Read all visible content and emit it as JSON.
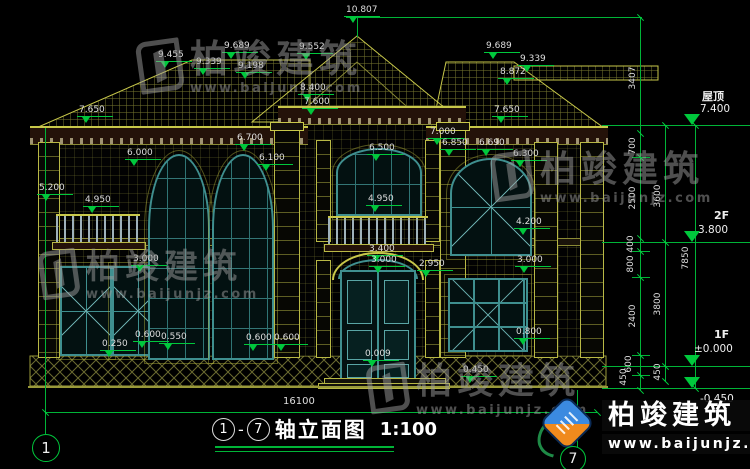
{
  "title": {
    "axis_from": "1",
    "dash": "-",
    "axis_to": "7",
    "name": "轴立面图",
    "scale": "1:100"
  },
  "bottom_dim": "16100",
  "axis_bubbles": {
    "left": "1",
    "right": "7"
  },
  "colors": {
    "dim_green": "#00c83c",
    "line_olive": "#b8b845",
    "window_teal": "#3f8f8f",
    "cornice_maroon": "#241209",
    "logo_blue": "#3b8ae0",
    "logo_orange": "#f08a1d"
  },
  "watermark": {
    "brand": "柏竣建筑",
    "url": "www.baijunjz.com",
    "instances": [
      {
        "x": 138,
        "y": 40,
        "cs": 38,
        "us": 13,
        "lw": 44,
        "lh": 52,
        "colored": false
      },
      {
        "x": 40,
        "y": 250,
        "cs": 34,
        "us": 13,
        "lw": 38,
        "lh": 48,
        "colored": false
      },
      {
        "x": 492,
        "y": 152,
        "cs": 36,
        "us": 13,
        "lw": 40,
        "lh": 48,
        "colored": false
      },
      {
        "x": 368,
        "y": 364,
        "cs": 36,
        "us": 13,
        "lw": 40,
        "lh": 48,
        "colored": false
      },
      {
        "x": 540,
        "y": 400,
        "cs": 27,
        "us": 14,
        "lw": 54,
        "lh": 56,
        "colored": true
      }
    ]
  },
  "elevation_markers": [
    {
      "v": "10.807",
      "x": 346,
      "y": 6
    },
    {
      "v": "9.552",
      "x": 299,
      "y": 43
    },
    {
      "v": "9.455",
      "x": 158,
      "y": 51
    },
    {
      "v": "9.339",
      "x": 196,
      "y": 58
    },
    {
      "v": "9.689",
      "x": 224,
      "y": 42
    },
    {
      "v": "9.198",
      "x": 238,
      "y": 62
    },
    {
      "v": "9.689",
      "x": 486,
      "y": 42
    },
    {
      "v": "9.339",
      "x": 520,
      "y": 55
    },
    {
      "v": "8.872",
      "x": 500,
      "y": 68
    },
    {
      "v": "8.400",
      "x": 300,
      "y": 84
    },
    {
      "v": "7.600",
      "x": 304,
      "y": 98
    },
    {
      "v": "7.650",
      "x": 79,
      "y": 106
    },
    {
      "v": "7.650",
      "x": 494,
      "y": 106
    },
    {
      "v": "7.000",
      "x": 430,
      "y": 128
    },
    {
      "v": "6.850",
      "x": 442,
      "y": 139
    },
    {
      "v": "6.690",
      "x": 479,
      "y": 139
    },
    {
      "v": "6.300",
      "x": 513,
      "y": 150
    },
    {
      "v": "6.700",
      "x": 237,
      "y": 134
    },
    {
      "v": "6.100",
      "x": 259,
      "y": 154
    },
    {
      "v": "6.000",
      "x": 127,
      "y": 149
    },
    {
      "v": "6.500",
      "x": 369,
      "y": 144
    },
    {
      "v": "5.200",
      "x": 39,
      "y": 184
    },
    {
      "v": "4.950",
      "x": 85,
      "y": 196
    },
    {
      "v": "4.950",
      "x": 368,
      "y": 195
    },
    {
      "v": "4.200",
      "x": 516,
      "y": 218
    },
    {
      "v": "3.400",
      "x": 369,
      "y": 245
    },
    {
      "v": "3.000",
      "x": 371,
      "y": 256
    },
    {
      "v": "2.950",
      "x": 419,
      "y": 260
    },
    {
      "v": "3.000",
      "x": 133,
      "y": 255
    },
    {
      "v": "3.000",
      "x": 517,
      "y": 256
    },
    {
      "v": "0.250",
      "x": 102,
      "y": 340
    },
    {
      "v": "0.600",
      "x": 135,
      "y": 331
    },
    {
      "v": "0.550",
      "x": 161,
      "y": 333
    },
    {
      "v": "0.600",
      "x": 246,
      "y": 334
    },
    {
      "v": "0.600",
      "x": 274,
      "y": 334
    },
    {
      "v": "0.800",
      "x": 516,
      "y": 328
    },
    {
      "v": "0.450",
      "x": 463,
      "y": 366
    },
    {
      "v": "0.009",
      "x": 365,
      "y": 350
    }
  ],
  "vertical_dims": [
    {
      "v": "3407",
      "x": 633,
      "y": 78
    },
    {
      "v": "700",
      "x": 633,
      "y": 146
    },
    {
      "v": "2500",
      "x": 633,
      "y": 198
    },
    {
      "v": "400",
      "x": 631,
      "y": 244
    },
    {
      "v": "800",
      "x": 631,
      "y": 264
    },
    {
      "v": "2400",
      "x": 633,
      "y": 316
    },
    {
      "v": "600",
      "x": 629,
      "y": 364
    },
    {
      "v": "450",
      "x": 624,
      "y": 377
    },
    {
      "v": "3600",
      "x": 658,
      "y": 196
    },
    {
      "v": "3800",
      "x": 658,
      "y": 304
    },
    {
      "v": "450",
      "x": 658,
      "y": 372
    },
    {
      "v": "7850",
      "x": 686,
      "y": 258
    }
  ],
  "levels": [
    {
      "name": "屋顶",
      "value": "7.400",
      "nx": 702,
      "ny": 88,
      "vx": 700,
      "vy": 103,
      "tx": 684,
      "ty": 114
    },
    {
      "name": "2F",
      "value": "3.800",
      "nx": 714,
      "ny": 209,
      "vx": 698,
      "vy": 224,
      "tx": 684,
      "ty": 231
    },
    {
      "name": "1F",
      "value": "±0.000",
      "nx": 714,
      "ny": 328,
      "vx": 694,
      "vy": 343,
      "tx": 684,
      "ty": 355
    },
    {
      "name": "",
      "value": "-0.450",
      "nx": 0,
      "ny": 0,
      "vx": 700,
      "vy": 393,
      "tx": 684,
      "ty": 377
    }
  ]
}
